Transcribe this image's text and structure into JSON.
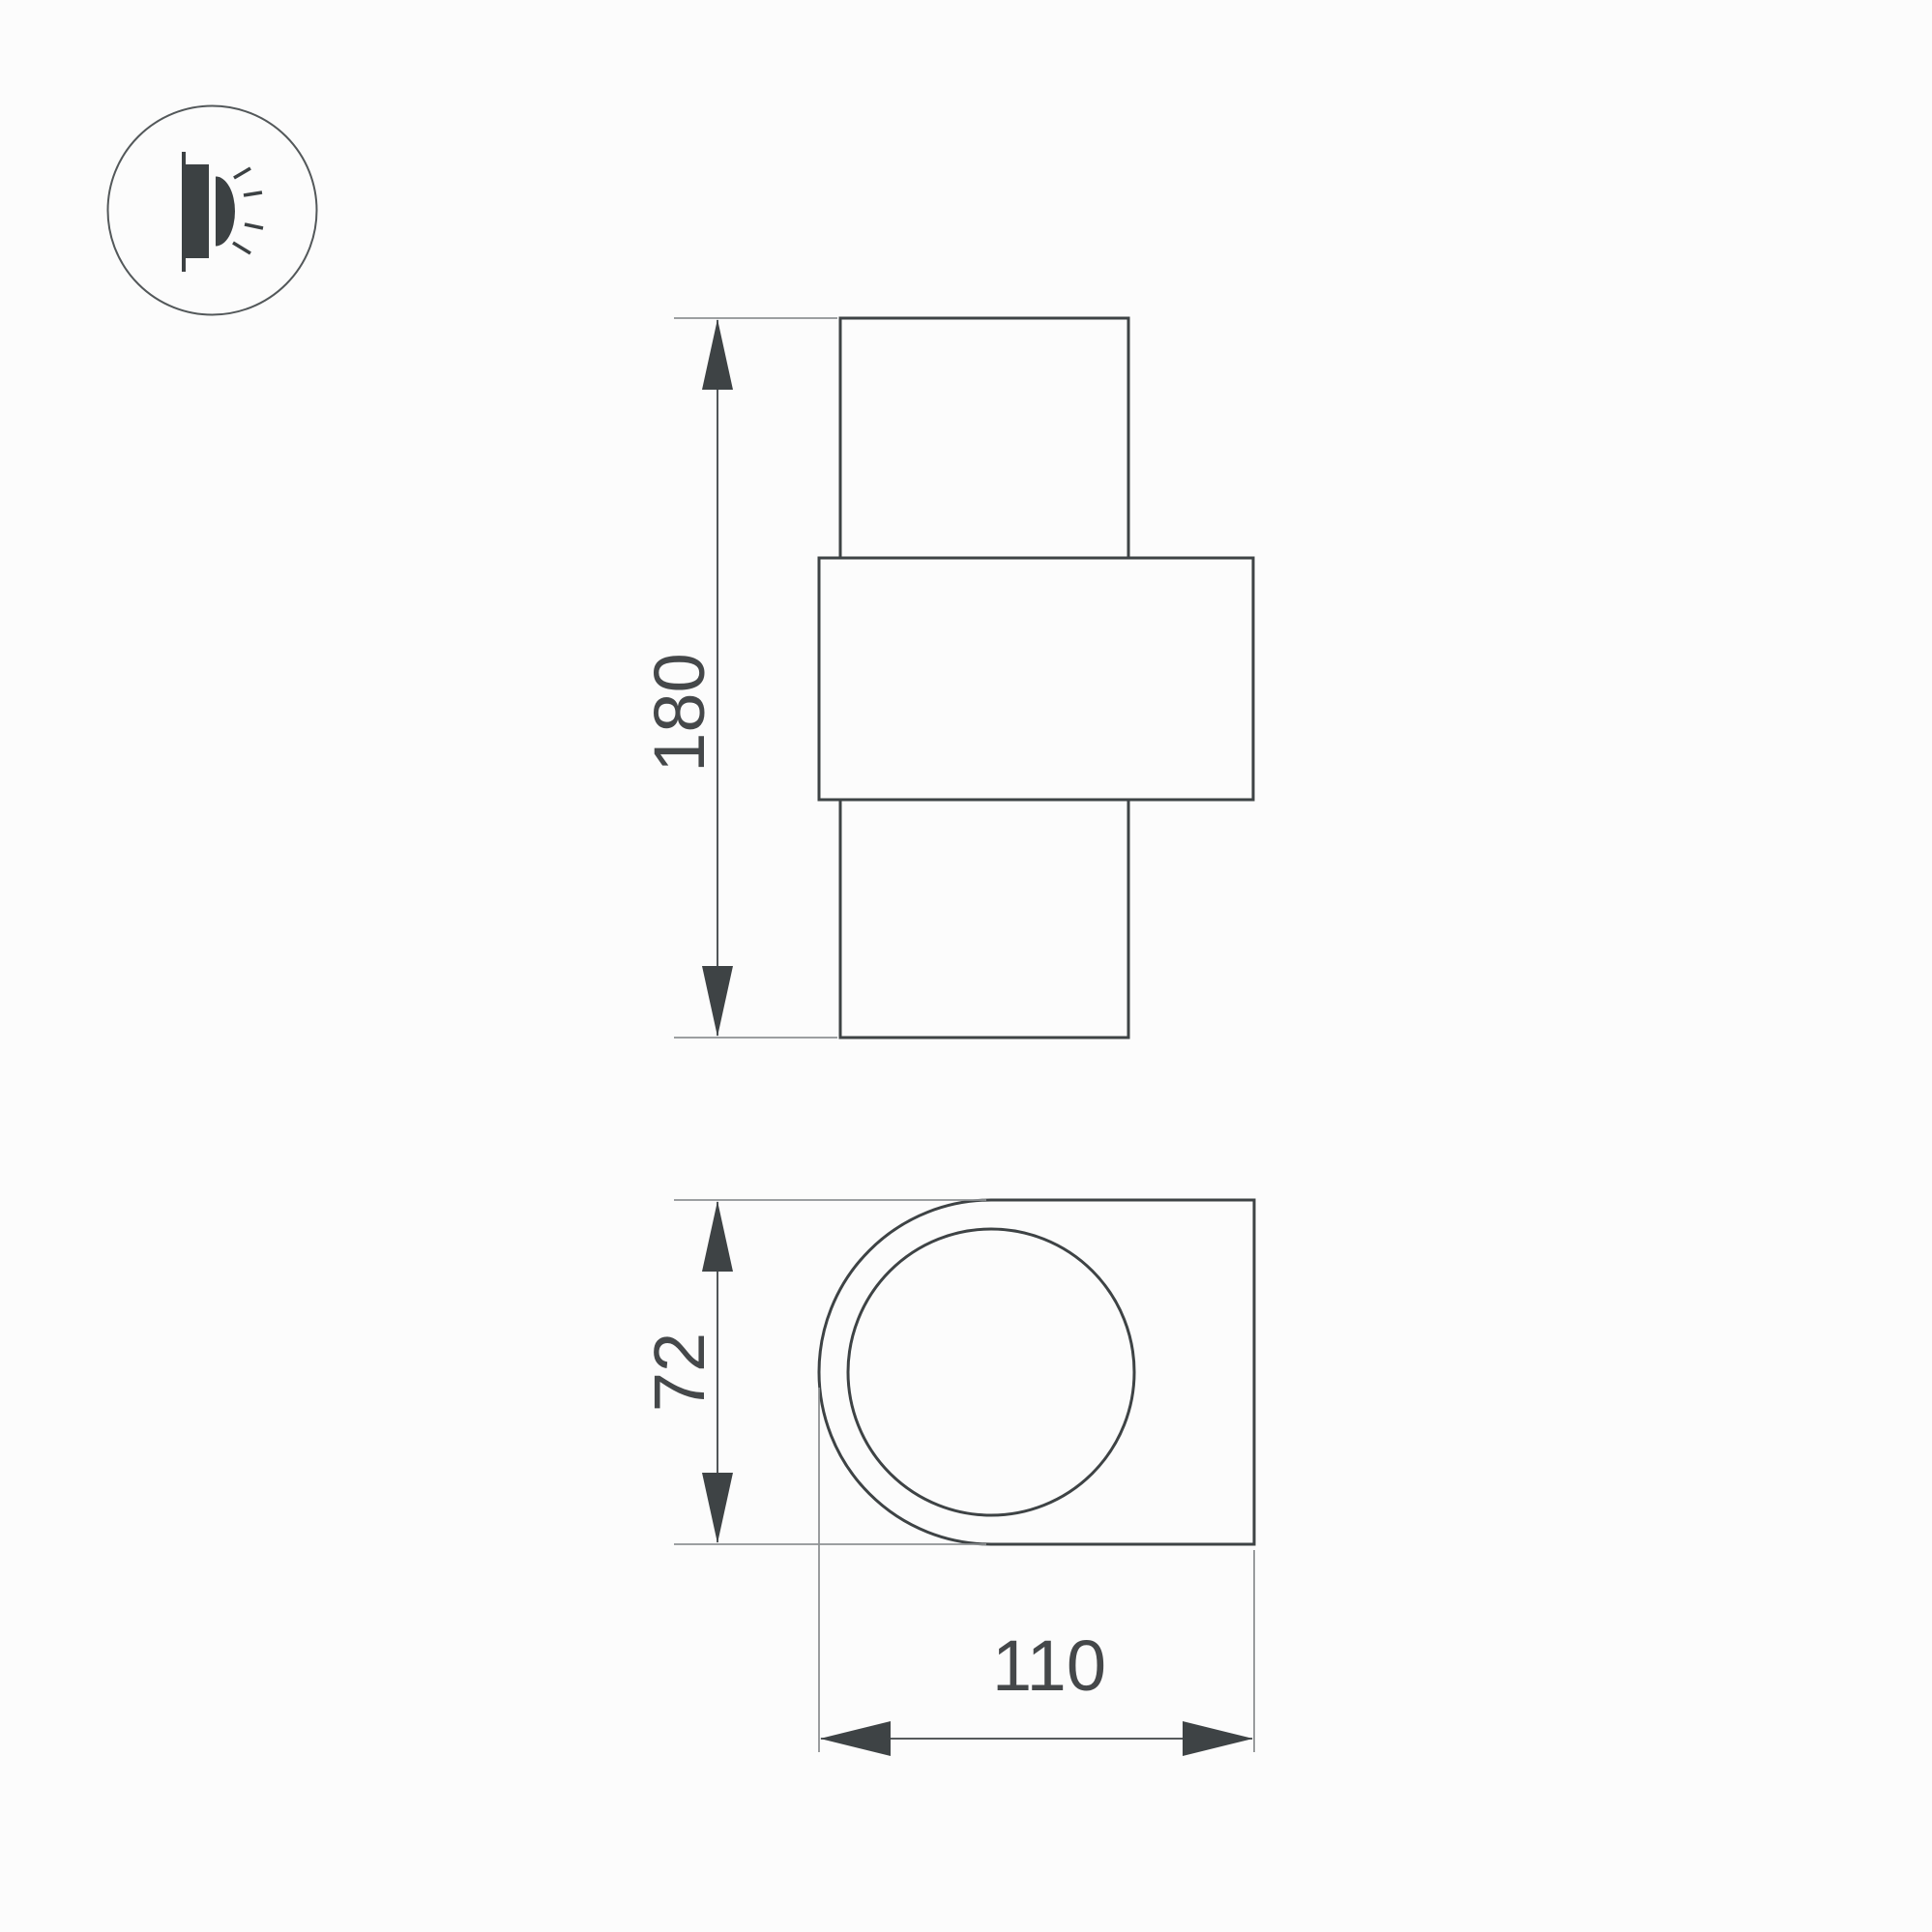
{
  "icon": {
    "name": "wall-lamp-side-glow-icon"
  },
  "front_view": {
    "height_label": "180"
  },
  "side_view": {
    "height_label": "72",
    "width_label": "110"
  },
  "colors": {
    "background": "#fcfcfc",
    "line": "#3e4345",
    "extension_line": "#8f9294",
    "dimension_text": "#45484a",
    "icon": "#3c4143",
    "icon_outline": "#53585a"
  }
}
